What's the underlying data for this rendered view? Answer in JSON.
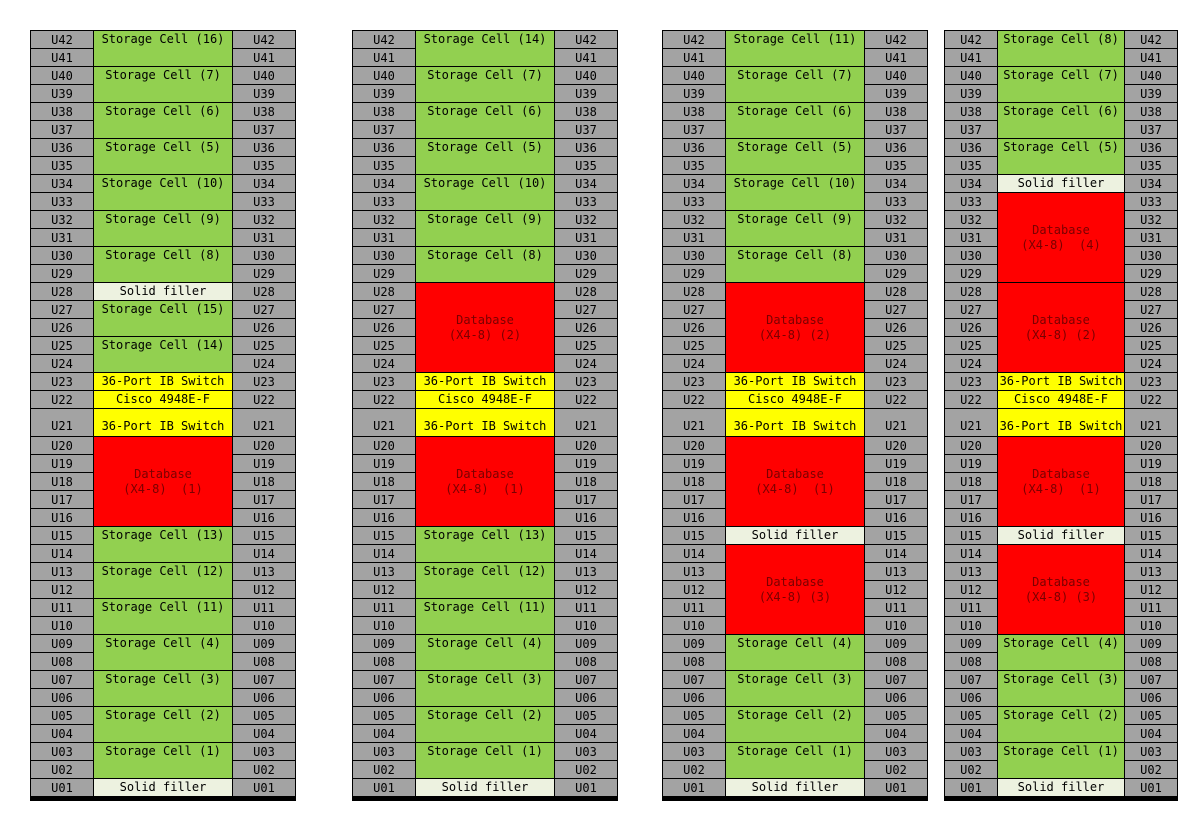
{
  "colors": {
    "storage": "#92D050",
    "database": "#FF0000",
    "switch": "#FFFF00",
    "filler": "#EDF2E0",
    "slot": "#A3A3A3",
    "border": "#000000",
    "database_text": "#7A0000"
  },
  "u_labels": [
    "U42",
    "U41",
    "U40",
    "U39",
    "U38",
    "U37",
    "U36",
    "U35",
    "U34",
    "U33",
    "U32",
    "U31",
    "U30",
    "U29",
    "U28",
    "U27",
    "U26",
    "U25",
    "U24",
    "U23",
    "U22",
    "U21",
    "U20",
    "U19",
    "U18",
    "U17",
    "U16",
    "U15",
    "U14",
    "U13",
    "U12",
    "U11",
    "U10",
    "U09",
    "U08",
    "U07",
    "U06",
    "U05",
    "U04",
    "U03",
    "U02",
    "U01"
  ],
  "racks": [
    {
      "name": "rack-1",
      "blocks": [
        {
          "type": "storage",
          "u_from": 42,
          "u_to": 41,
          "label": "Storage Cell (16)"
        },
        {
          "type": "storage",
          "u_from": 40,
          "u_to": 39,
          "label": "Storage Cell (7)"
        },
        {
          "type": "storage",
          "u_from": 38,
          "u_to": 37,
          "label": "Storage Cell (6)"
        },
        {
          "type": "storage",
          "u_from": 36,
          "u_to": 35,
          "label": "Storage Cell (5)"
        },
        {
          "type": "storage",
          "u_from": 34,
          "u_to": 33,
          "label": "Storage Cell (10)"
        },
        {
          "type": "storage",
          "u_from": 32,
          "u_to": 31,
          "label": "Storage Cell (9)"
        },
        {
          "type": "storage",
          "u_from": 30,
          "u_to": 29,
          "label": "Storage Cell (8)"
        },
        {
          "type": "filler",
          "u_from": 28,
          "u_to": 28,
          "label": "Solid filler"
        },
        {
          "type": "storage",
          "u_from": 27,
          "u_to": 26,
          "label": "Storage Cell (15)"
        },
        {
          "type": "storage",
          "u_from": 25,
          "u_to": 24,
          "label": "Storage Cell (14)"
        },
        {
          "type": "switch",
          "u_from": 23,
          "u_to": 23,
          "label": "36-Port IB Switch"
        },
        {
          "type": "cisco",
          "u_from": 22,
          "u_to": 22,
          "label": "Cisco 4948E-F"
        },
        {
          "type": "switch",
          "u_from": 21,
          "u_to": 21,
          "label": "36-Port IB Switch"
        },
        {
          "type": "database",
          "u_from": 20,
          "u_to": 16,
          "label": "Database",
          "label2": "(X4-8)  (1)"
        },
        {
          "type": "storage",
          "u_from": 15,
          "u_to": 14,
          "label": "Storage Cell (13)"
        },
        {
          "type": "storage",
          "u_from": 13,
          "u_to": 12,
          "label": "Storage Cell (12)"
        },
        {
          "type": "storage",
          "u_from": 11,
          "u_to": 10,
          "label": "Storage Cell (11)"
        },
        {
          "type": "storage",
          "u_from": 9,
          "u_to": 8,
          "label": "Storage Cell (4)"
        },
        {
          "type": "storage",
          "u_from": 7,
          "u_to": 6,
          "label": "Storage Cell (3)"
        },
        {
          "type": "storage",
          "u_from": 5,
          "u_to": 4,
          "label": "Storage Cell (2)"
        },
        {
          "type": "storage",
          "u_from": 3,
          "u_to": 2,
          "label": "Storage Cell (1)"
        },
        {
          "type": "filler",
          "u_from": 1,
          "u_to": 1,
          "label": "Solid filler"
        }
      ]
    },
    {
      "name": "rack-2",
      "blocks": [
        {
          "type": "storage",
          "u_from": 42,
          "u_to": 41,
          "label": "Storage Cell (14)"
        },
        {
          "type": "storage",
          "u_from": 40,
          "u_to": 39,
          "label": "Storage Cell (7)"
        },
        {
          "type": "storage",
          "u_from": 38,
          "u_to": 37,
          "label": "Storage Cell (6)"
        },
        {
          "type": "storage",
          "u_from": 36,
          "u_to": 35,
          "label": "Storage Cell (5)"
        },
        {
          "type": "storage",
          "u_from": 34,
          "u_to": 33,
          "label": "Storage Cell (10)"
        },
        {
          "type": "storage",
          "u_from": 32,
          "u_to": 31,
          "label": "Storage Cell (9)"
        },
        {
          "type": "storage",
          "u_from": 30,
          "u_to": 29,
          "label": "Storage Cell (8)"
        },
        {
          "type": "database",
          "u_from": 28,
          "u_to": 24,
          "label": "Database",
          "label2": "(X4-8) (2)"
        },
        {
          "type": "switch",
          "u_from": 23,
          "u_to": 23,
          "label": "36-Port IB Switch"
        },
        {
          "type": "cisco",
          "u_from": 22,
          "u_to": 22,
          "label": "Cisco 4948E-F"
        },
        {
          "type": "switch",
          "u_from": 21,
          "u_to": 21,
          "label": "36-Port IB Switch"
        },
        {
          "type": "database",
          "u_from": 20,
          "u_to": 16,
          "label": "Database",
          "label2": "(X4-8)  (1)"
        },
        {
          "type": "storage",
          "u_from": 15,
          "u_to": 14,
          "label": "Storage Cell (13)"
        },
        {
          "type": "storage",
          "u_from": 13,
          "u_to": 12,
          "label": "Storage Cell (12)"
        },
        {
          "type": "storage",
          "u_from": 11,
          "u_to": 10,
          "label": "Storage Cell (11)"
        },
        {
          "type": "storage",
          "u_from": 9,
          "u_to": 8,
          "label": "Storage Cell (4)"
        },
        {
          "type": "storage",
          "u_from": 7,
          "u_to": 6,
          "label": "Storage Cell (3)"
        },
        {
          "type": "storage",
          "u_from": 5,
          "u_to": 4,
          "label": "Storage Cell (2)"
        },
        {
          "type": "storage",
          "u_from": 3,
          "u_to": 2,
          "label": "Storage Cell (1)"
        },
        {
          "type": "filler",
          "u_from": 1,
          "u_to": 1,
          "label": "Solid filler"
        }
      ]
    },
    {
      "name": "rack-3",
      "blocks": [
        {
          "type": "storage",
          "u_from": 42,
          "u_to": 41,
          "label": "Storage Cell (11)"
        },
        {
          "type": "storage",
          "u_from": 40,
          "u_to": 39,
          "label": "Storage Cell (7)"
        },
        {
          "type": "storage",
          "u_from": 38,
          "u_to": 37,
          "label": "Storage Cell (6)"
        },
        {
          "type": "storage",
          "u_from": 36,
          "u_to": 35,
          "label": "Storage Cell (5)"
        },
        {
          "type": "storage",
          "u_from": 34,
          "u_to": 33,
          "label": "Storage Cell (10)"
        },
        {
          "type": "storage",
          "u_from": 32,
          "u_to": 31,
          "label": "Storage Cell (9)"
        },
        {
          "type": "storage",
          "u_from": 30,
          "u_to": 29,
          "label": "Storage Cell (8)"
        },
        {
          "type": "database",
          "u_from": 28,
          "u_to": 24,
          "label": "Database",
          "label2": "(X4-8) (2)"
        },
        {
          "type": "switch",
          "u_from": 23,
          "u_to": 23,
          "label": "36-Port IB Switch"
        },
        {
          "type": "cisco",
          "u_from": 22,
          "u_to": 22,
          "label": "Cisco 4948E-F"
        },
        {
          "type": "switch",
          "u_from": 21,
          "u_to": 21,
          "label": "36-Port IB Switch"
        },
        {
          "type": "database",
          "u_from": 20,
          "u_to": 16,
          "label": "Database",
          "label2": "(X4-8)  (1)"
        },
        {
          "type": "filler",
          "u_from": 15,
          "u_to": 15,
          "label": "Solid filler"
        },
        {
          "type": "database",
          "u_from": 14,
          "u_to": 10,
          "label": "Database",
          "label2": "(X4-8) (3)"
        },
        {
          "type": "storage",
          "u_from": 9,
          "u_to": 8,
          "label": "Storage Cell (4)"
        },
        {
          "type": "storage",
          "u_from": 7,
          "u_to": 6,
          "label": "Storage Cell (3)"
        },
        {
          "type": "storage",
          "u_from": 5,
          "u_to": 4,
          "label": "Storage Cell (2)"
        },
        {
          "type": "storage",
          "u_from": 3,
          "u_to": 2,
          "label": "Storage Cell (1)"
        },
        {
          "type": "filler",
          "u_from": 1,
          "u_to": 1,
          "label": "Solid filler"
        }
      ]
    },
    {
      "name": "rack-4",
      "blocks": [
        {
          "type": "storage",
          "u_from": 42,
          "u_to": 41,
          "label": "Storage Cell (8)"
        },
        {
          "type": "storage",
          "u_from": 40,
          "u_to": 39,
          "label": "Storage Cell (7)"
        },
        {
          "type": "storage",
          "u_from": 38,
          "u_to": 37,
          "label": "Storage Cell (6)"
        },
        {
          "type": "storage",
          "u_from": 36,
          "u_to": 35,
          "label": "Storage Cell (5)"
        },
        {
          "type": "filler",
          "u_from": 34,
          "u_to": 34,
          "label": "Solid filler"
        },
        {
          "type": "database",
          "u_from": 33,
          "u_to": 29,
          "label": "Database",
          "label2": "(X4-8)  (4)"
        },
        {
          "type": "database",
          "u_from": 28,
          "u_to": 24,
          "label": "Database",
          "label2": "(X4-8) (2)"
        },
        {
          "type": "switch",
          "u_from": 23,
          "u_to": 23,
          "label": "36-Port IB Switch"
        },
        {
          "type": "cisco",
          "u_from": 22,
          "u_to": 22,
          "label": "Cisco 4948E-F"
        },
        {
          "type": "switch",
          "u_from": 21,
          "u_to": 21,
          "label": "36-Port IB Switch"
        },
        {
          "type": "database",
          "u_from": 20,
          "u_to": 16,
          "label": "Database",
          "label2": "(X4-8)  (1)"
        },
        {
          "type": "filler",
          "u_from": 15,
          "u_to": 15,
          "label": "Solid filler"
        },
        {
          "type": "database",
          "u_from": 14,
          "u_to": 10,
          "label": "Database",
          "label2": "(X4-8) (3)"
        },
        {
          "type": "storage",
          "u_from": 9,
          "u_to": 8,
          "label": "Storage Cell (4)"
        },
        {
          "type": "storage",
          "u_from": 7,
          "u_to": 6,
          "label": "Storage Cell (3)"
        },
        {
          "type": "storage",
          "u_from": 5,
          "u_to": 4,
          "label": "Storage Cell (2)"
        },
        {
          "type": "storage",
          "u_from": 3,
          "u_to": 2,
          "label": "Storage Cell (1)"
        },
        {
          "type": "filler",
          "u_from": 1,
          "u_to": 1,
          "label": "Solid filler"
        }
      ]
    }
  ]
}
